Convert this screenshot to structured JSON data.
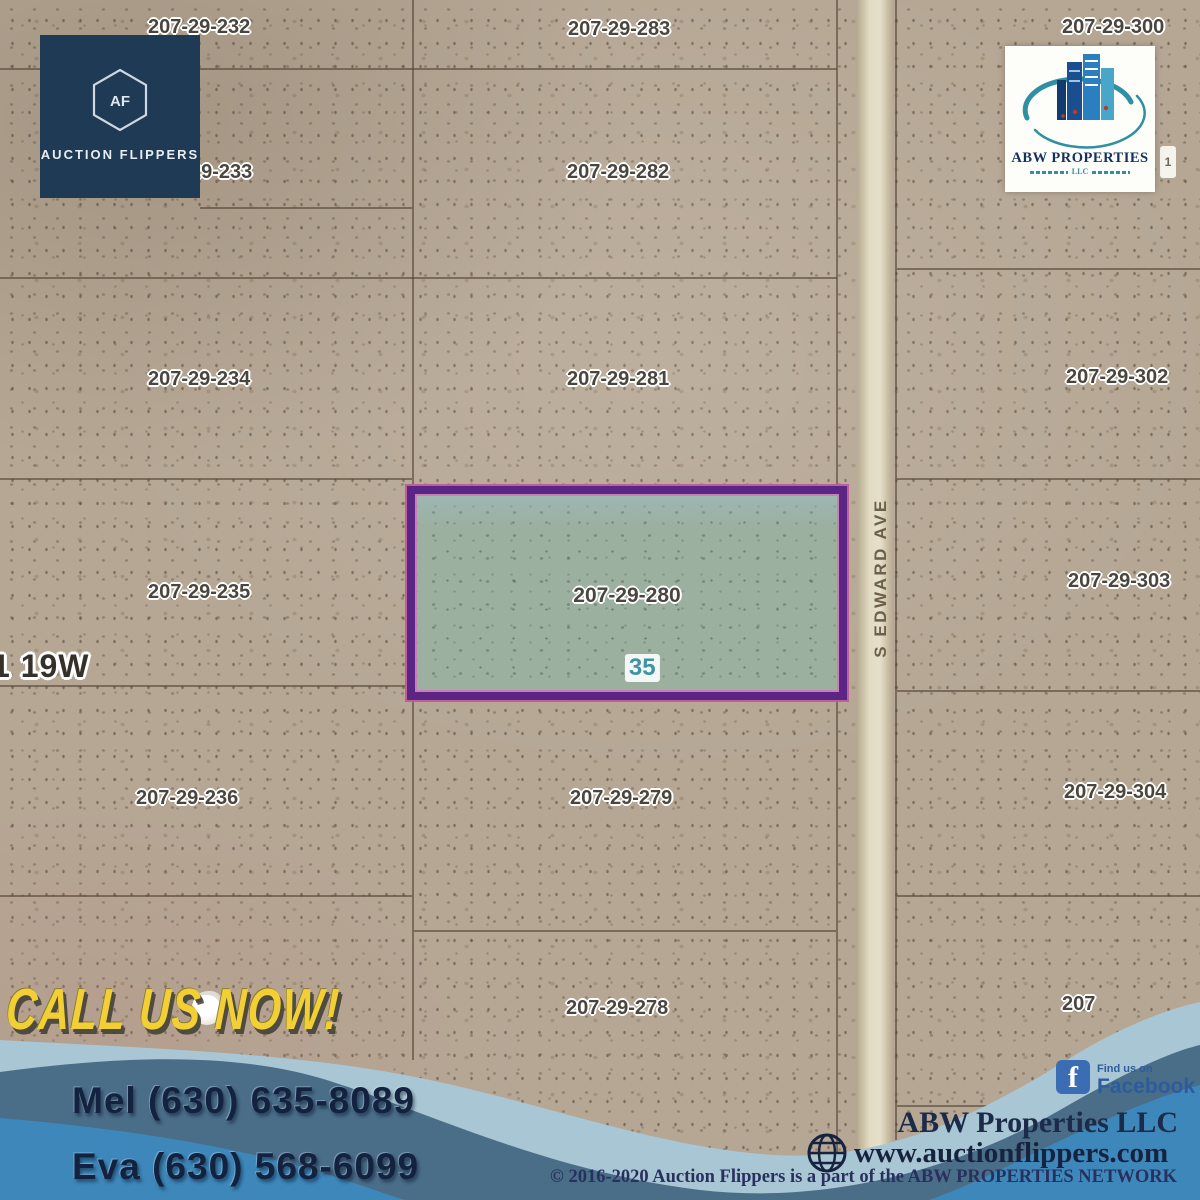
{
  "branding": {
    "auction_flippers": {
      "initials": "AF",
      "name": "AUCTION FLIPPERS"
    },
    "abw_logo": {
      "name": "ABW PROPERTIES",
      "sub": "LLC"
    }
  },
  "map": {
    "township_label": "1 19W",
    "road_name": "S EDWARD AVE",
    "edge_partial_label": "1",
    "highlight": {
      "label": "207-29-280",
      "lot": "35"
    },
    "parcels": [
      {
        "label": "207-29-232",
        "x": 148,
        "y": 16
      },
      {
        "label": "207-29-283",
        "x": 568,
        "y": 18
      },
      {
        "label": "207-29-300",
        "x": 1062,
        "y": 16
      },
      {
        "label": "207-29-233",
        "x": 150,
        "y": 161
      },
      {
        "label": "207-29-282",
        "x": 567,
        "y": 161
      },
      {
        "label": "207-29-234",
        "x": 148,
        "y": 368
      },
      {
        "label": "207-29-281",
        "x": 567,
        "y": 368
      },
      {
        "label": "207-29-302",
        "x": 1066,
        "y": 366
      },
      {
        "label": "207-29-235",
        "x": 148,
        "y": 581
      },
      {
        "label": "207-29-303",
        "x": 1068,
        "y": 570
      },
      {
        "label": "207-29-236",
        "x": 136,
        "y": 787
      },
      {
        "label": "207-29-279",
        "x": 570,
        "y": 787
      },
      {
        "label": "207-29-304",
        "x": 1064,
        "y": 781
      },
      {
        "label": "207-29-278",
        "x": 566,
        "y": 997
      },
      {
        "label": "207",
        "x": 1062,
        "y": 993
      }
    ]
  },
  "contact": {
    "headline": "CALL US NOW!",
    "phones": [
      "Mel (630) 635-8089",
      "Eva (630) 568-6099"
    ]
  },
  "footer": {
    "facebook_small": "Find us on",
    "facebook_big": "Facebook",
    "company": "ABW Properties LLC",
    "website": "www.auctionflippers.com",
    "copyright": "© 2016-2020 Auction Flippers is a part of the ABW PROPERTIES NETWORK"
  },
  "colors": {
    "map_base": "#b6a795",
    "highlight_fill": "#9cb0a0",
    "highlight_border": "#5b2585",
    "wave_light": "#a9c6d4",
    "wave_dark": "#4a6d88",
    "wave_bright": "#3d87ba",
    "headline_yellow": "#f1cf35",
    "navy": "#13233f"
  }
}
